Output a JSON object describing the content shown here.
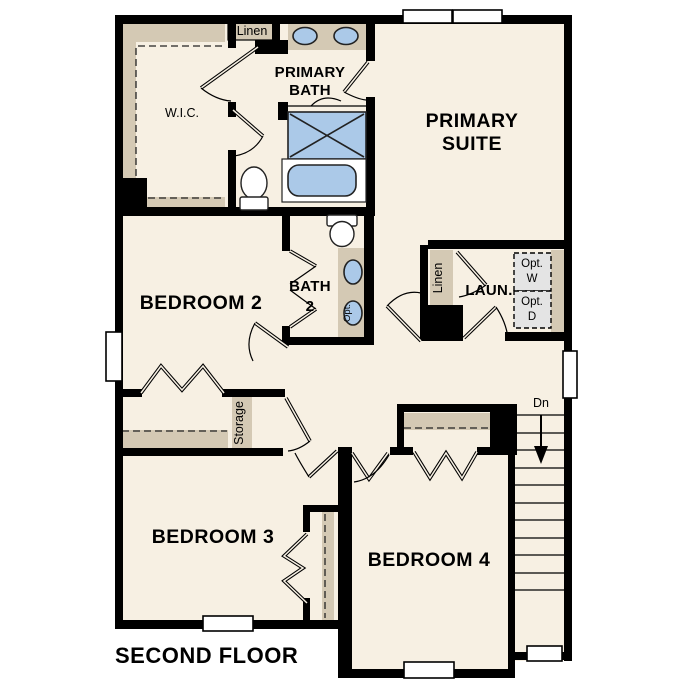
{
  "title": {
    "label": "SECOND FLOOR"
  },
  "colors": {
    "floor": "#f7f0e3",
    "wall": "#000000",
    "casework_tan": "#d4c9b4",
    "fixture_blue": "#abc9e8",
    "optional_gray": "#e4e4e4",
    "window_white": "#ffffff"
  },
  "rooms": {
    "primary_suite": {
      "label_line1": "PRIMARY",
      "label_line2": "SUITE"
    },
    "primary_bath": {
      "label_line1": "PRIMARY",
      "label_line2": "BATH"
    },
    "wic": {
      "label": "W.I.C."
    },
    "bedroom_2": {
      "label": "BEDROOM 2"
    },
    "bath_2": {
      "label_line1": "BATH",
      "label_line2": "2"
    },
    "bedroom_3": {
      "label": "BEDROOM 3"
    },
    "bedroom_4": {
      "label": "BEDROOM 4"
    },
    "laundry": {
      "label": "LAUN."
    }
  },
  "closets": {
    "linen_upper": {
      "label": "Linen"
    },
    "linen_laundry": {
      "label": "Linen"
    },
    "storage": {
      "label": "Storage"
    }
  },
  "annotations": {
    "stair_direction": {
      "label": "Dn"
    },
    "optional_washer": {
      "label_line1": "Opt.",
      "label_line2": "W"
    },
    "optional_dryer": {
      "label_line1": "Opt.",
      "label_line2": "D"
    },
    "optional_sink": {
      "label": "Opt."
    }
  }
}
